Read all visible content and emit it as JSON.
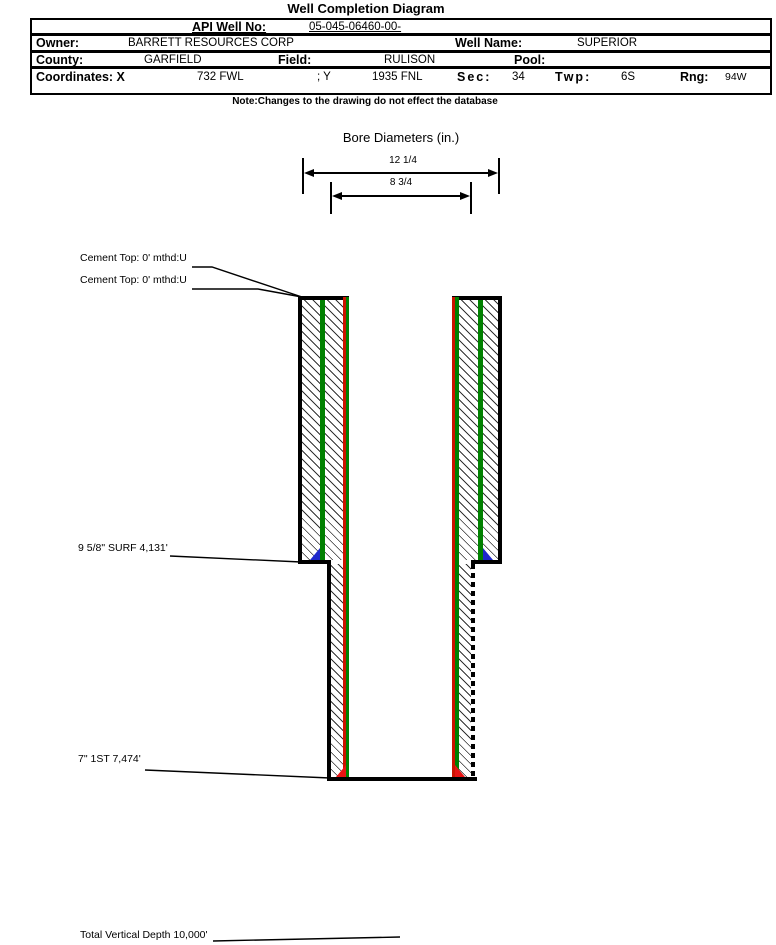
{
  "title": "Well Completion Diagram",
  "table": {
    "api_label": "API Well No:",
    "api_value": "05-045-06460-00-",
    "owner_label": "Owner:",
    "owner_value": "BARRETT RESOURCES CORP",
    "well_name_label": "Well Name:",
    "well_name_value": "SUPERIOR",
    "county_label": "County:",
    "county_value": "GARFIELD",
    "field_label": "Field:",
    "field_value": "RULISON",
    "pool_label": "Pool:",
    "pool_value": "",
    "coordinates_label": "Coordinates: X",
    "x_value": "732 FWL",
    "y_label": "; Y",
    "y_value": "1935 FNL",
    "sec_label": "Sec:",
    "sec_value": "34",
    "twp_label": "Twp:",
    "twp_value": "6S",
    "rng_label": "Rng:",
    "rng_value": "94W"
  },
  "note": "Note:Changes to the drawing do not effect the database",
  "bore": {
    "title": "Bore Diameters (in.)",
    "diameters": [
      "12 1/4",
      "8 3/4"
    ]
  },
  "labels": {
    "cement_top_1": "Cement Top: 0' mthd:U",
    "cement_top_2": "Cement Top: 0' mthd:U",
    "surface_casing": "9 5/8\" SURF 4,131'",
    "production_casing": "7\" 1ST 7,474'",
    "tvd": "Total Vertical Depth 10,000'"
  },
  "colors": {
    "casing_green": "#008000",
    "tubing_red": "#cc1400",
    "shoe_blue": "#1e28cc",
    "shoe_red": "#e81414"
  }
}
